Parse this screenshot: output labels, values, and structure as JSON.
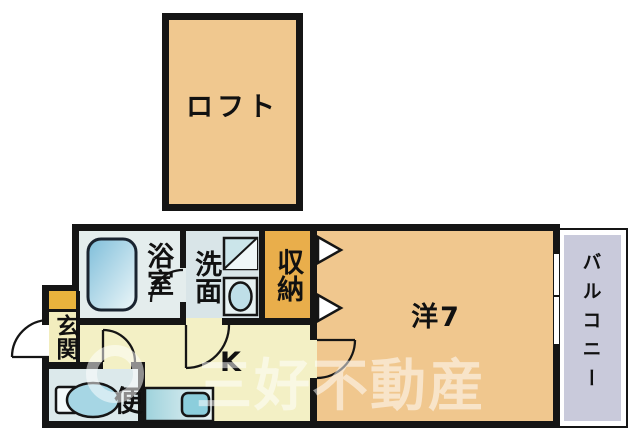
{
  "rooms": {
    "loft": {
      "label": "ロフト"
    },
    "bath": {
      "label": "浴室"
    },
    "washroom": {
      "label": "洗面"
    },
    "closet": {
      "label": "収納"
    },
    "entrance": {
      "label": "玄関"
    },
    "toilet": {
      "label": "便"
    },
    "kitchen": {
      "label": "K"
    },
    "western_room": {
      "label": "洋7"
    },
    "balcony": {
      "label": "バルコニー"
    }
  },
  "watermark": {
    "text": "三好不動産"
  },
  "colors": {
    "wall": "#151515",
    "room_tan": "#F0C78E",
    "hall_cream": "#F3F0C5",
    "wet_area_blue": "#DFE9EB",
    "closet_orange": "#E9AE4B",
    "entrance_gold": "#E9B33D",
    "entrance_floor": "#F2EDBE",
    "balcony_lavender": "#C9CADB"
  }
}
